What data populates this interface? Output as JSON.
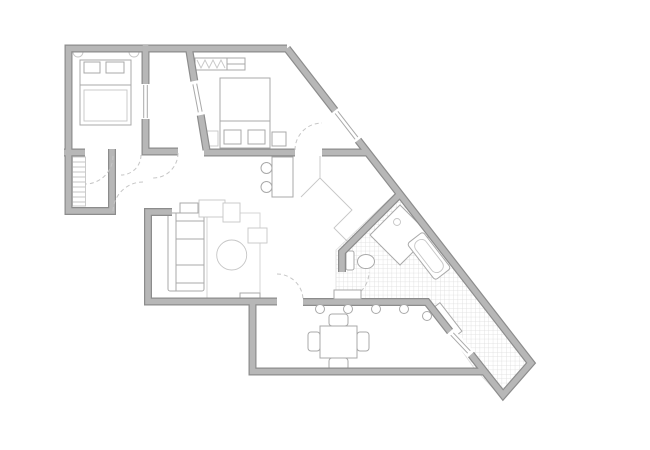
{
  "meta": {
    "title": "Apartment floor plan drawing"
  },
  "colors": {
    "background": "#ffffff",
    "wall_edge": "#8c8c8c",
    "wall_fill": "#b7b7b7",
    "furniture_stroke": "#a9a9a9",
    "thin_stroke": "#c6c6c6",
    "rug_stroke": "#d6d6d6",
    "tile_grid": "#dddddd"
  },
  "floorplan": {
    "canvas": {
      "width": 650,
      "height": 450
    },
    "tile": {
      "pitch": 4.4,
      "polygon": "399,190 534,364 503,399 474,368 427,301 336,301 336,250"
    },
    "walls": [
      {
        "name": "wall-exterior-top-left",
        "d": "M287,48.5 L68.5,48.5 L68.5,211 L112,211 L112,149"
      },
      {
        "name": "wall-bedroom1-south-stub",
        "d": "M64,152.5 L85,152.5"
      },
      {
        "name": "wall-bedroom1-east",
        "d": "M145.5,45 L145.5,85 M145.5,118 L145.5,151.5 L178,151.5"
      },
      {
        "name": "wall-bedroom-partition",
        "d": "M189,48.5 L194.8,84 M200.2,112 L206.5,150"
      },
      {
        "name": "wall-bedroom2-south",
        "d": "M204,152.5 L295,152.5"
      },
      {
        "name": "wall-vestibule-top",
        "d": "M322,152.5 L369,152.5"
      },
      {
        "name": "wall-exterior-diagonal-upper",
        "d": "M287,48.5 L336.5,112.4"
      },
      {
        "name": "wall-exterior-diagonal-main",
        "d": "M356.5,138.2 L531,363 L503,395 L469,352"
      },
      {
        "name": "wall-bathroom-diagonal",
        "d": "M399,195 L342,252 L342,272"
      },
      {
        "name": "wall-living-west-south",
        "d": "M172,212 L148,212 L148,301.5 L277,301.5"
      },
      {
        "name": "wall-dining-left-bottom",
        "d": "M252.5,301.5 L252.5,371.5 L486,371.5"
      },
      {
        "name": "wall-terrace-railing",
        "d": "M303,302 L427,302 L452,334"
      }
    ],
    "windows": [
      {
        "name": "window-bedroom1-east",
        "gap": "M145.5,84 L145.5,119",
        "panes": [
          "M143.7,85 L143.7,118",
          "M147.3,85 L147.3,118"
        ]
      },
      {
        "name": "window-partition",
        "gap": "M194.2,81 L200.8,115",
        "panes": [
          "M192.9,84.4 L198.3,112.4",
          "M196.7,83.6 L202.1,111.6"
        ]
      },
      {
        "name": "window-exterior-diagonal",
        "gap": "M335,110.5 L358,140.2",
        "panes": [
          "M335.1,113.5 L355.1,139.3",
          "M337.9,111.3 L357.9,137.1"
        ]
      },
      {
        "name": "window-terrace",
        "gap": "M450,331.5 L471,354.5",
        "panes": [
          "M450.7,335.2 L467.7,353.2",
          "M453.3,332.8 L470.3,350.8"
        ]
      }
    ],
    "doors": [
      {
        "name": "door-arc-bedroom1",
        "d": "M141,155 A20,20 0 0 1 121,175"
      },
      {
        "name": "door-arc-closet",
        "d": "M113,156 A28,28 0 0 1 85,184"
      },
      {
        "name": "door-arc-hall-to-living",
        "d": "M143,182 A30,30 0 0 0 113,212"
      },
      {
        "name": "door-arc-hall-east",
        "d": "M178,153 A25,25 0 0 1 153,178"
      },
      {
        "name": "door-arc-bedroom2",
        "d": "M295,150 A27,27 0 0 1 322,123"
      },
      {
        "name": "door-arc-living-dining",
        "d": "M277,274 A26,26 0 0 1 303,300"
      },
      {
        "name": "door-arc-bathroom",
        "d": "M342,299 A27,27 0 0 0 369,272"
      }
    ],
    "furniture": [
      {
        "t": "path",
        "name": "sconce-arc-left",
        "cls": "thin-line",
        "d": "M73,52 A5,5 0 0 0 83,52"
      },
      {
        "t": "path",
        "name": "sconce-arc-right",
        "cls": "thin-line",
        "d": "M129,52 A5,5 0 0 0 139,52"
      },
      {
        "t": "rect",
        "name": "bed-1",
        "x": 80,
        "y": 60,
        "w": 51,
        "h": 65
      },
      {
        "t": "path",
        "name": "bed-1-fold-line",
        "cls": "furn-line",
        "d": "M80,85 L131,85"
      },
      {
        "t": "rect",
        "name": "bed-1-duvet",
        "cls": "thin",
        "x": 84,
        "y": 90,
        "w": 43,
        "h": 31
      },
      {
        "t": "rect",
        "name": "bed-1-pillow-left",
        "x": 84,
        "y": 62,
        "w": 16,
        "h": 11
      },
      {
        "t": "rect",
        "name": "bed-1-pillow-right",
        "x": 106,
        "y": 62,
        "w": 18,
        "h": 11
      },
      {
        "t": "hatch",
        "name": "closet-shelves",
        "x": 72.5,
        "y": 157,
        "w": 13,
        "h": 49,
        "step": 5
      },
      {
        "t": "rect",
        "name": "wardrobe-bedroom2",
        "x": 195,
        "y": 58,
        "w": 50,
        "h": 12
      },
      {
        "t": "polyline",
        "name": "wardrobe-hanging-clothes",
        "cls": "thin-line",
        "points": "197,60 201,68 205,60 209,68 213,60 217,68 221,60 225,68"
      },
      {
        "t": "path",
        "name": "wardrobe-divider",
        "cls": "furn-line",
        "d": "M227,58 L227,70 M227,64 L245,64"
      },
      {
        "t": "rect",
        "name": "bed-2",
        "x": 220,
        "y": 78,
        "w": 50,
        "h": 70
      },
      {
        "t": "path",
        "name": "bed-2-fold-line",
        "cls": "furn-line",
        "d": "M220,121 L270,121"
      },
      {
        "t": "rect",
        "name": "bed-2-pillow-left",
        "x": 224,
        "y": 130,
        "w": 17,
        "h": 14
      },
      {
        "t": "rect",
        "name": "bed-2-pillow-right",
        "x": 248,
        "y": 130,
        "w": 17,
        "h": 14
      },
      {
        "t": "rect",
        "name": "nightstand-left",
        "cls": "thin",
        "x": 207,
        "y": 131,
        "w": 11,
        "h": 15
      },
      {
        "t": "rect",
        "name": "nightstand-right",
        "x": 272,
        "y": 132,
        "w": 14,
        "h": 14
      },
      {
        "t": "rect",
        "name": "desk",
        "x": 272,
        "y": 157,
        "w": 21,
        "h": 40
      },
      {
        "t": "circle",
        "name": "desk-chair-top",
        "cx": 266.5,
        "cy": 168,
        "r": 5.5
      },
      {
        "t": "circle",
        "name": "desk-chair-bottom",
        "cx": 266.5,
        "cy": 187,
        "r": 5.5
      },
      {
        "t": "rect",
        "name": "rug",
        "cls": "rug",
        "x": 207,
        "y": 213,
        "w": 53,
        "h": 85
      },
      {
        "t": "rect",
        "name": "sofa-side-table",
        "x": 180,
        "y": 203,
        "w": 18,
        "h": 10
      },
      {
        "t": "rect",
        "name": "sofa",
        "x": 168,
        "y": 213,
        "w": 36,
        "h": 78,
        "rx": 2
      },
      {
        "t": "path",
        "name": "sofa-cushion-lines",
        "cls": "furn-line",
        "d": "M176,213 L176,291 M176,221 L204,221 M176,239 L204,239 M176,265 L204,265 M176,283 L204,283"
      },
      {
        "t": "rect",
        "name": "armchair-north-a",
        "cls": "thin",
        "x": 199,
        "y": 200,
        "w": 26,
        "h": 17
      },
      {
        "t": "rect",
        "name": "armchair-north-b",
        "cls": "thin",
        "x": 223,
        "y": 203,
        "w": 17,
        "h": 19
      },
      {
        "t": "rect",
        "name": "side-square-table",
        "cls": "thin",
        "x": 248,
        "y": 228,
        "w": 19,
        "h": 15
      },
      {
        "t": "circle",
        "name": "coffee-table",
        "cls": "thin",
        "cx": 231.7,
        "cy": 255,
        "r": 15
      },
      {
        "t": "rect",
        "name": "tv-bench",
        "x": 240,
        "y": 293,
        "w": 20,
        "h": 6
      },
      {
        "t": "polyline",
        "name": "vestibule-closet-edge",
        "cls": "thin-line",
        "points": "320,156 320,178 301,197"
      },
      {
        "t": "polyline",
        "name": "vestibule-closet-front",
        "cls": "thin-line",
        "points": "320,178 352,210 334,228 351,245"
      },
      {
        "t": "polygon",
        "name": "shower-tray",
        "points": "400,205 430,235 400,265 370,235"
      },
      {
        "t": "circle",
        "name": "shower-drain",
        "cls": "thin",
        "cx": 397,
        "cy": 222,
        "r": 3.5
      },
      {
        "t": "rect",
        "name": "toilet-tank",
        "x": 346,
        "y": 251,
        "w": 8,
        "h": 19,
        "rx": 2
      },
      {
        "t": "ellipse",
        "name": "toilet-bowl",
        "cx": 366,
        "cy": 261.5,
        "rx": 8.5,
        "ry": 7
      },
      {
        "t": "rect",
        "name": "bathtub",
        "x": 406,
        "y": 246,
        "w": 46,
        "h": 20,
        "rx": 3,
        "transform": "rotate(52.3 429 256)"
      },
      {
        "t": "rect",
        "name": "bathtub-inner",
        "cls": "thin",
        "x": 410,
        "y": 249.5,
        "w": 38,
        "h": 13,
        "rx": 6,
        "transform": "rotate(52.3 429 256)"
      },
      {
        "t": "rect",
        "name": "terrace-bench",
        "x": 429,
        "y": 315,
        "w": 36,
        "h": 10,
        "transform": "rotate(52.3 447 320)"
      },
      {
        "t": "rect",
        "name": "dining-table",
        "x": 320,
        "y": 326,
        "w": 37,
        "h": 32
      },
      {
        "t": "rect",
        "name": "dining-chair-north",
        "x": 329,
        "y": 314,
        "w": 19,
        "h": 12,
        "rx": 3
      },
      {
        "t": "rect",
        "name": "dining-chair-south",
        "x": 329,
        "y": 358,
        "w": 19,
        "h": 12,
        "rx": 3
      },
      {
        "t": "rect",
        "name": "dining-chair-west",
        "x": 308,
        "y": 332,
        "w": 12,
        "h": 19,
        "rx": 3
      },
      {
        "t": "rect",
        "name": "dining-chair-east",
        "x": 357,
        "y": 332,
        "w": 12,
        "h": 19,
        "rx": 3
      }
    ],
    "railing": {
      "r": 4.5,
      "posts": [
        [
          320,
          309
        ],
        [
          348,
          309
        ],
        [
          376,
          309
        ],
        [
          404,
          309
        ],
        [
          427,
          316
        ]
      ]
    },
    "sill": {
      "x": 334,
      "y": 290,
      "w": 27,
      "h": 9
    }
  }
}
